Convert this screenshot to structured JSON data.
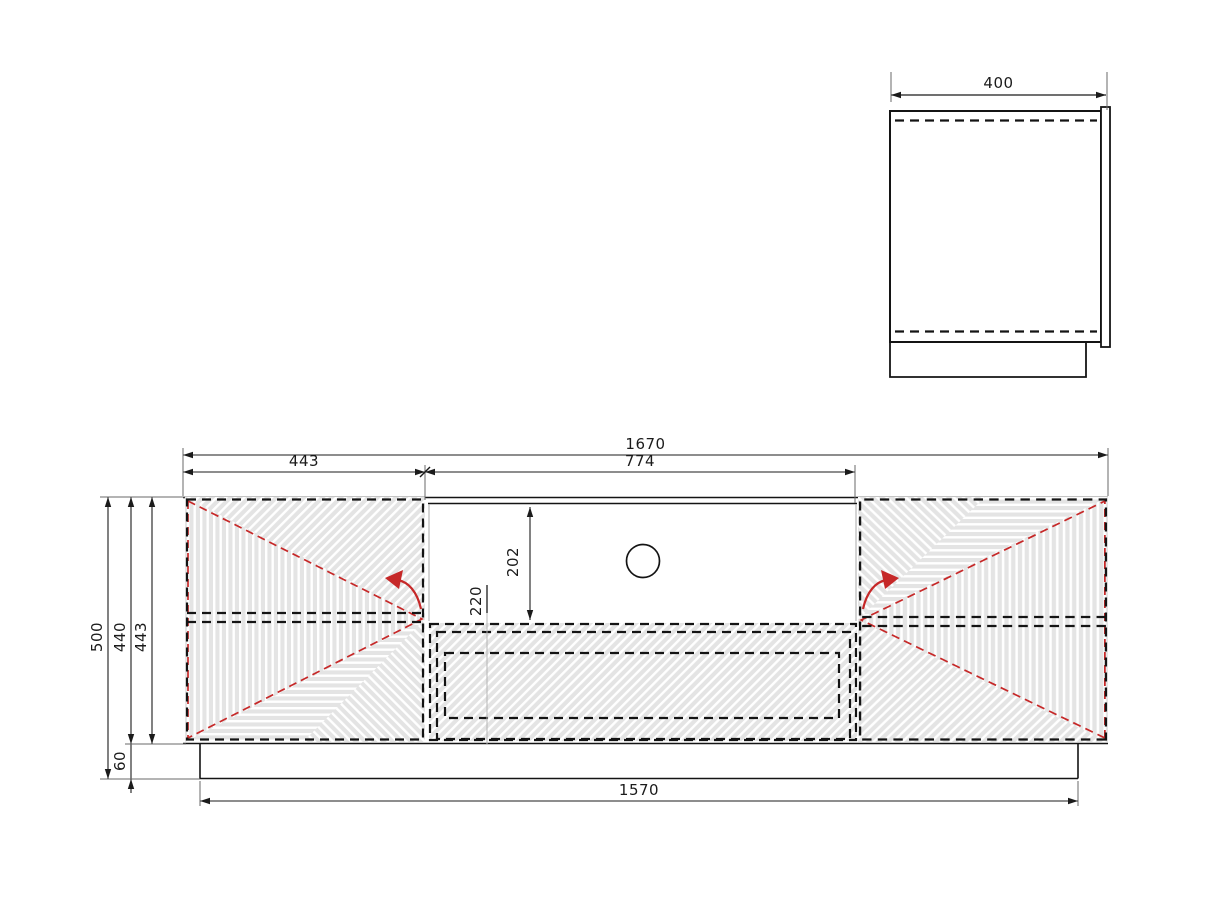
{
  "drawing": {
    "side_view": {
      "depth": "400"
    },
    "front_view": {
      "overall_width": "1670",
      "left_door_width": "443",
      "middle_width": "774",
      "niche_height": "202",
      "drawer_front_height": "220",
      "overall_height": "500",
      "carcass_height": "440",
      "door_height": "443",
      "plinth_height": "60",
      "base_width": "1570"
    },
    "colors": {
      "line": "#1b1b1b",
      "accent_red": "#c62828",
      "panel_gray": "#e4e4e4",
      "groove_white": "#ffffff"
    }
  }
}
